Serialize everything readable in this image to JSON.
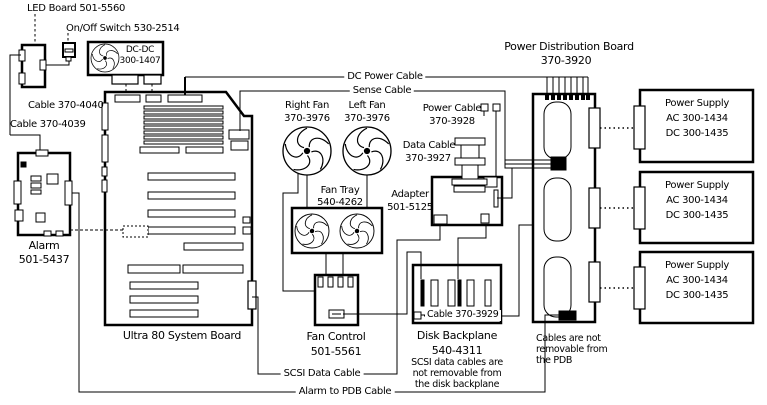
{
  "colors": {
    "ink": "#000000",
    "paper": "#ffffff"
  },
  "components": {
    "led_board": {
      "label": "LED Board 501-5560"
    },
    "onoff_switch": {
      "label": "On/Off Switch 530-2514"
    },
    "dcdc_converter": {
      "name": "DC-DC",
      "part": "300-1407"
    },
    "alarm": {
      "name": "Alarm",
      "part": "501-5437"
    },
    "system_board": {
      "label": "Ultra 80 System Board"
    },
    "right_fan": {
      "name": "Right Fan",
      "part": "370-3976"
    },
    "left_fan": {
      "name": "Left Fan",
      "part": "370-3976"
    },
    "fan_tray": {
      "name": "Fan Tray",
      "part": "540-4262"
    },
    "fan_control": {
      "name": "Fan Control",
      "part": "501-5561"
    },
    "adapter": {
      "name": "Adapter",
      "part": "501-5125"
    },
    "pdb": {
      "name": "Power Distribution Board",
      "part": "370-3920",
      "note": [
        "Cables are not",
        "removable from",
        "the PDB"
      ]
    },
    "disk_backplane": {
      "name": "Disk  Backplane",
      "part": "540-4311",
      "note": [
        "SCSI data cables are",
        "not removable from",
        "the disk backplane"
      ]
    },
    "power_supplies": [
      {
        "name": "Power Supply",
        "ac": "AC 300-1434",
        "dc": "DC 300-1435"
      },
      {
        "name": "Power Supply",
        "ac": "AC 300-1434",
        "dc": "DC 300-1435"
      },
      {
        "name": "Power Supply",
        "ac": "AC 300-1434",
        "dc": "DC 300-1435"
      }
    ]
  },
  "cables": {
    "dc_power": {
      "label": "DC Power Cable"
    },
    "sense": {
      "label": "Sense Cable"
    },
    "power": {
      "name": "Power Cable",
      "part": "370-3928"
    },
    "data": {
      "name": "Data Cable",
      "part": "370-3927"
    },
    "scsi_data": {
      "label": "SCSI Data Cable"
    },
    "alarm_to_pdb": {
      "label": "Alarm to PDB Cable"
    },
    "cable_370_4040": {
      "label": "Cable 370-4040"
    },
    "cable_370_4039": {
      "label": "Cable 370-4039"
    },
    "cable_370_3929": {
      "label": "Cable 370-3929"
    }
  }
}
